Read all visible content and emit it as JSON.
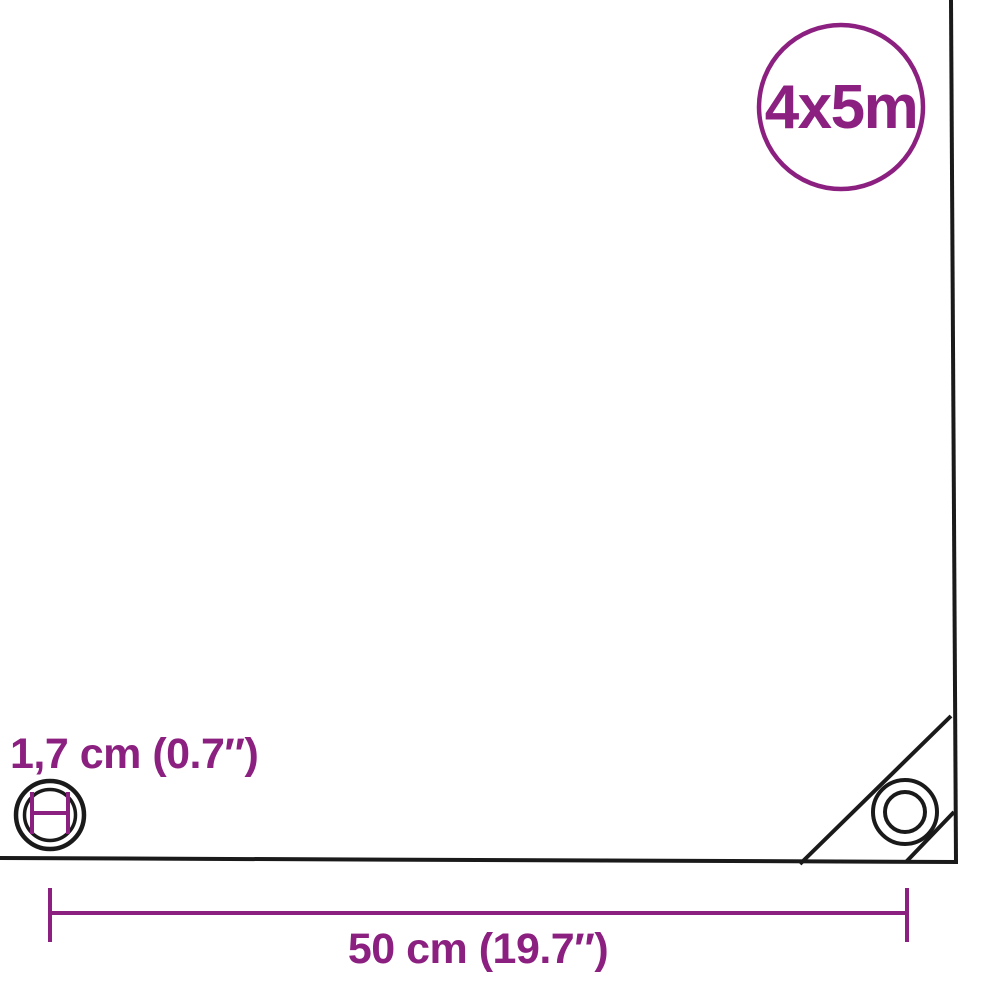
{
  "colors": {
    "accent": "#8C2080",
    "outline": "#1A1A1A",
    "background": "#FFFFFF"
  },
  "badge": {
    "label": "4x5m"
  },
  "annotations": {
    "grommet_diameter_label": "1,7 cm (0.7″)",
    "grommet_spacing_label": "50 cm (19.7″)"
  },
  "icons": {
    "badge": "size-badge-circle-icon",
    "left": "grommet-diameter-icon",
    "corner": "corner-grommet-icon",
    "dimension": "spacing-dimension-line-icon"
  }
}
